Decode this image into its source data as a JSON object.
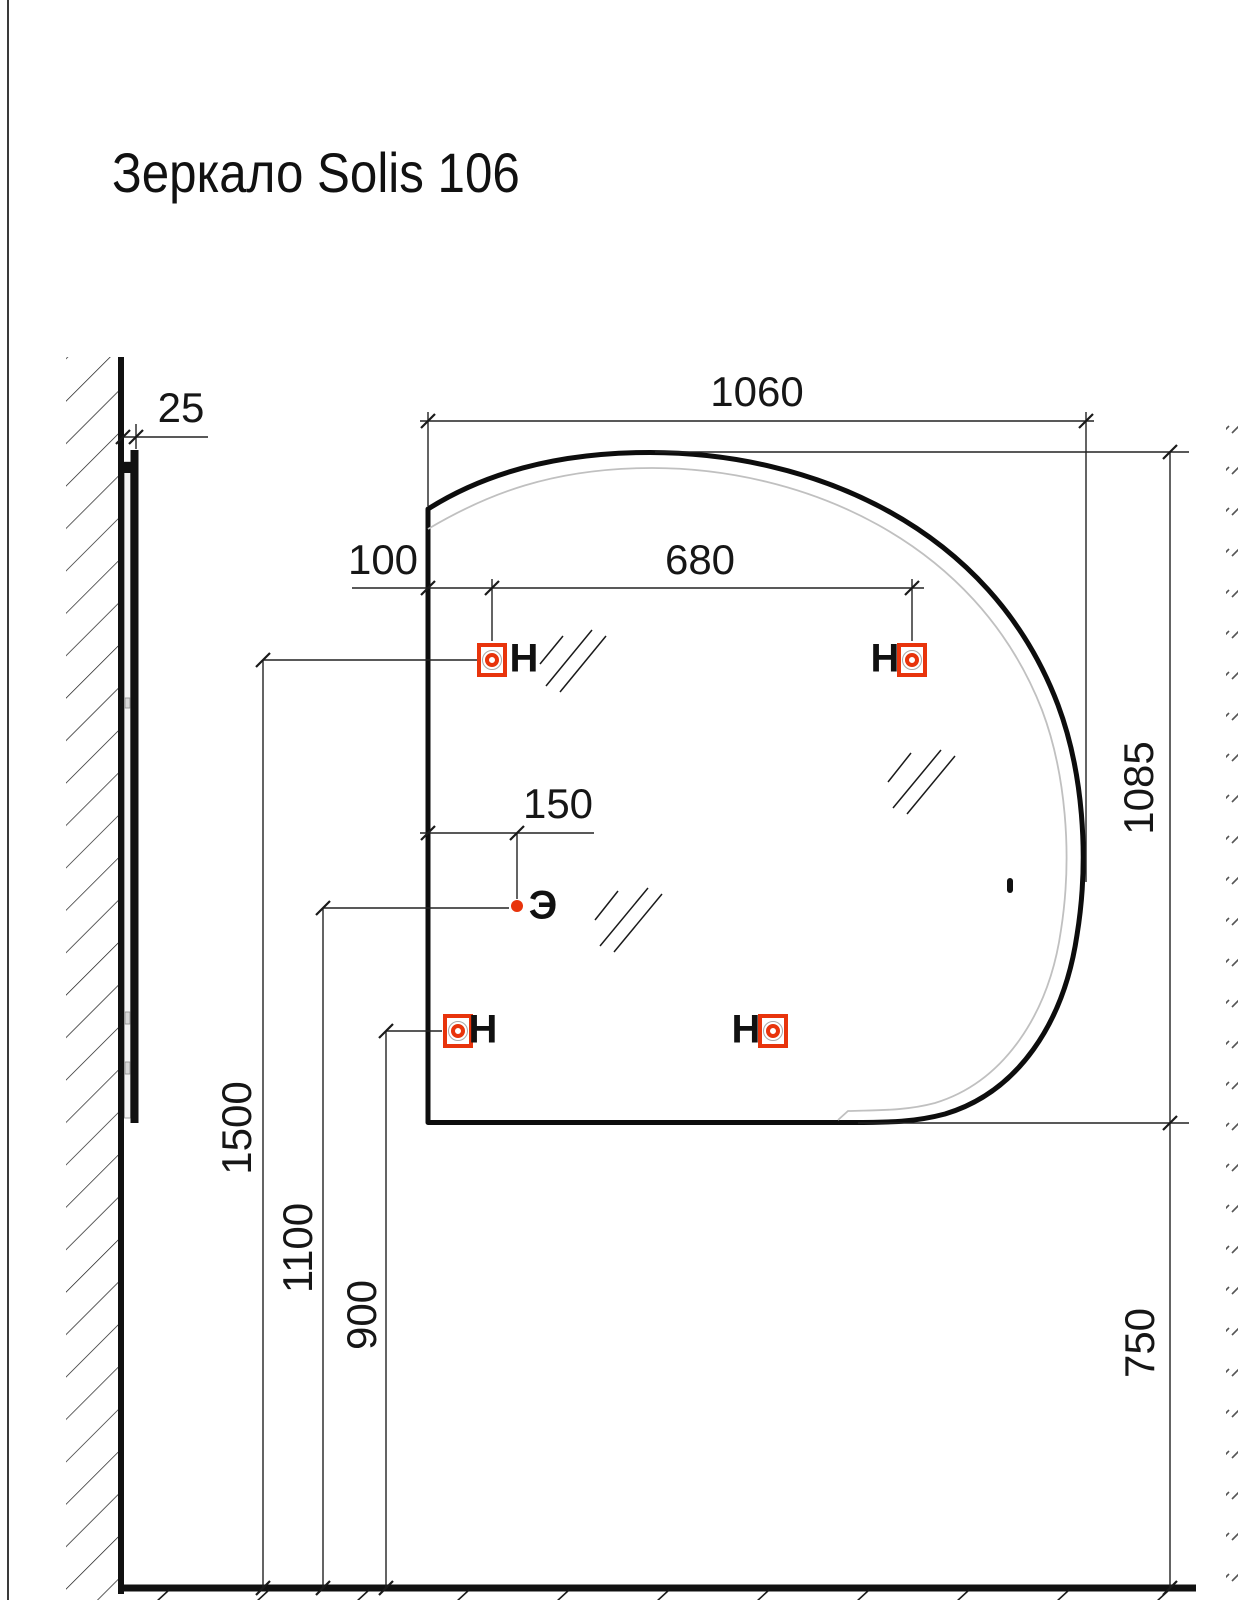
{
  "title": "Зеркало Solis 106",
  "dimensions_mm": {
    "wall_offset": "25",
    "mirror_width": "1060",
    "hanger_left_offset": "100",
    "hanger_spacing": "680",
    "mirror_height": "1085",
    "outlet_horizontal_offset": "150",
    "upper_hangers_height": "1500",
    "outlet_height": "1100",
    "lower_hangers_height": "900",
    "mirror_bottom_height": "750"
  },
  "markers": {
    "hanger": "Н",
    "electrical_outlet": "Э"
  },
  "icons": {
    "hanger_point": "red square with fastener circle",
    "electrical_point": "red dot",
    "glass_symbol": "double diagonal slashes",
    "wall_section": "diagonal hatch"
  },
  "colors": {
    "line": "#1a1a1a",
    "accent_red": "#e8340c",
    "led_strip_gray": "#c0c0c0"
  }
}
